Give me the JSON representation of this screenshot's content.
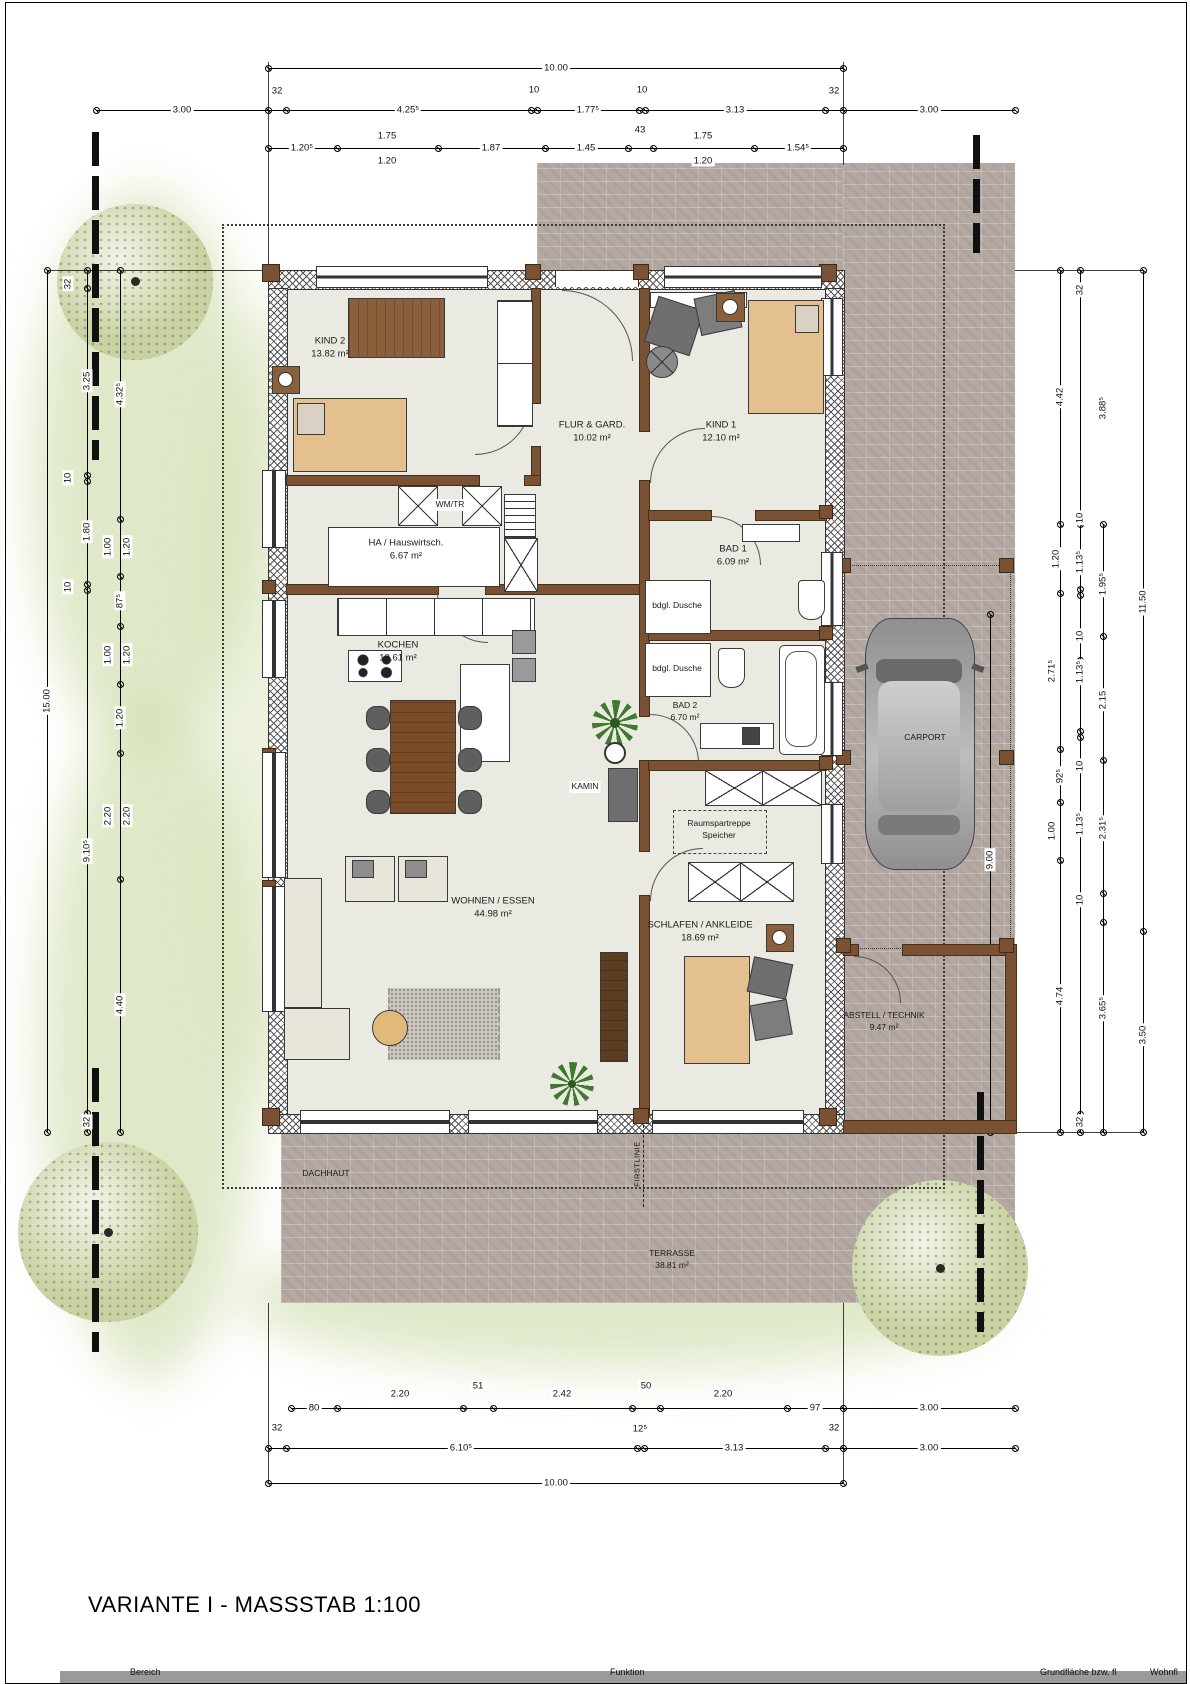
{
  "title": "VARIANTE I - MASSSTAB 1:100",
  "rooms": {
    "kind2": {
      "name": "KIND 2",
      "area": "13.82 m²"
    },
    "flur": {
      "name": "FLUR & GARD.",
      "area": "10.02 m²"
    },
    "kind1": {
      "name": "KIND 1",
      "area": "12.10 m²"
    },
    "wmtr": {
      "name": "WM/TR"
    },
    "ha": {
      "name": "HA / Hauswirtsch.",
      "area": "6.67 m²"
    },
    "bad1": {
      "name": "BAD 1",
      "area": "6.09 m²"
    },
    "kochen": {
      "name": "KOCHEN",
      "area": "10.61 m²"
    },
    "dusche1": {
      "name": "bdgl. Dusche"
    },
    "dusche2": {
      "name": "bdgl. Dusche"
    },
    "bad2": {
      "name": "BAD 2",
      "area": "6.70 m²"
    },
    "kamin": {
      "name": "KAMIN"
    },
    "raumspartreppe": {
      "name": "Raumspartreppe",
      "line2": "Speicher"
    },
    "wohnen": {
      "name": "WOHNEN / ESSEN",
      "area": "44.98 m²"
    },
    "schlafen": {
      "name": "SCHLAFEN / ANKLEIDE",
      "area": "18.69 m²"
    },
    "abstell": {
      "name": "ABSTELL / TECHNIK",
      "area": "9.47 m²"
    },
    "carport": {
      "name": "CARPORT"
    },
    "terrasse": {
      "name": "TERRASSE",
      "area": "38.81 m²"
    },
    "dachhaut": {
      "name": "DACHHAUT"
    },
    "firstlinie": {
      "name": "FIRSTLINIE"
    }
  },
  "dims": {
    "top": {
      "overall": "10.00",
      "b": [
        "3.00",
        "32",
        "4.25⁵",
        "10",
        "1.77⁵",
        "10",
        "3.13",
        "32",
        "3.00"
      ],
      "c": [
        "1.20⁵",
        "1.75",
        "1.20",
        "1.87",
        "1.45",
        "43",
        "1.75",
        "1.20",
        "1.54⁵"
      ]
    },
    "bottom": {
      "r1": [
        "80",
        "2.20",
        "51",
        "2.42",
        "50",
        "2.20",
        "97",
        "3.00"
      ],
      "r2": [
        "32",
        "6.10⁵",
        "12⁵",
        "3.13",
        "32",
        "3.00"
      ],
      "overall": "10.00"
    },
    "left": {
      "outer": "15.00",
      "mid": [
        "32",
        "3.25",
        "10",
        "1.80",
        "10",
        "9.10⁵",
        "32"
      ],
      "fine": [
        "4.32⁵",
        "1.00",
        "1.20",
        "87⁵",
        "1.00",
        "1.20",
        "1.20",
        "2.20",
        "2.20",
        "4.40"
      ]
    },
    "right": {
      "a": [
        "4.42",
        "1.20",
        "2.71⁵",
        "92⁵",
        "1.00",
        "4.74"
      ],
      "b": [
        "32",
        "10",
        "1.13⁵",
        "10",
        "1.13⁵",
        "10",
        "1.13⁵",
        "10",
        "32"
      ],
      "c": [
        "3.88⁵",
        "1.95⁵",
        "2.15",
        "2.31⁵",
        "3.65⁵"
      ],
      "d": [
        "11.50",
        "3.50"
      ],
      "carport_depth": "9.00"
    }
  },
  "footer": {
    "columns": [
      "Bereich",
      "Funktion",
      "Grundfläche bzw. fl",
      "Wohnfl"
    ]
  },
  "colors": {
    "paving": "#b4a8a3",
    "floor": "#ebeae2",
    "wall_wood": "#7b5134",
    "bed": "#e3c08e",
    "tree": "#c8d2a2"
  }
}
